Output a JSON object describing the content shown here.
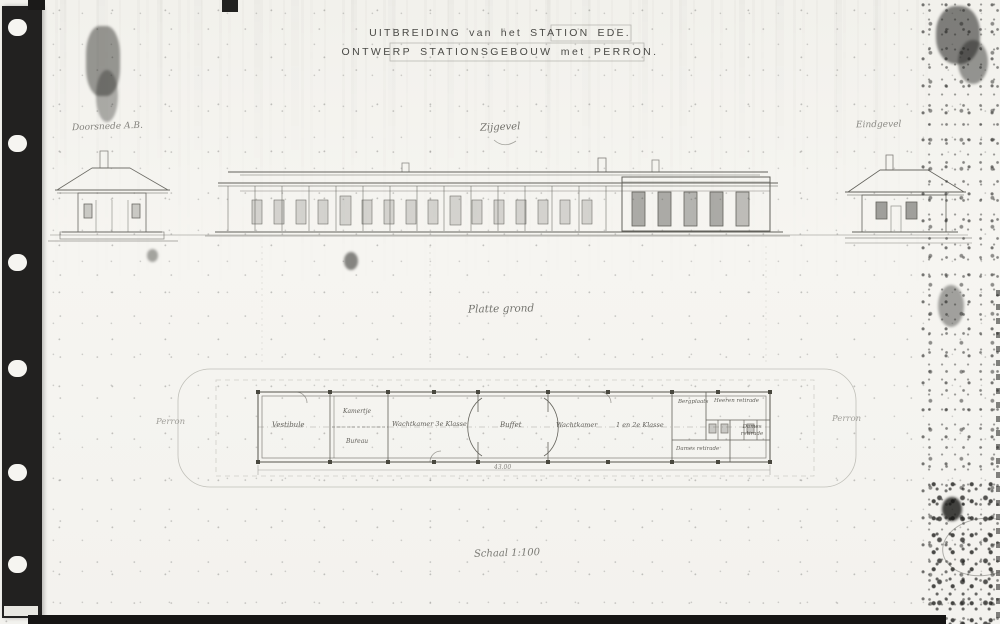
{
  "document": {
    "title_line1": "UITBREIDING van het STATION EDE.",
    "title_line2": "ONTWERP STATIONSGEBOUW met PERRON.",
    "scale_note": "Schaal 1:100"
  },
  "annotations": {
    "left_elevation": "Doorsnede A.B.",
    "side_elevation": "Zijgevel",
    "end_elevation": "Eindgevel",
    "floor_plan": "Platte grond",
    "platform_left": "Perron",
    "platform_right": "Perron",
    "dimension_length": "43.00"
  },
  "plan_rooms": {
    "vestibule": "Vestibule",
    "kamertje": "Kamertje",
    "bureau": "Bureau",
    "wachtkamer_3e_klasse": "Wachtkamer 3e Klasse",
    "buffet": "Buffet",
    "wachtkamer": "Wachtkamer",
    "klasse_1_en_2": "1 en 2e Klasse",
    "bergplaats": "Bergplaats",
    "heeren_retirade": "Heeren retirade",
    "dames_retirade_right": "Dames retirade",
    "dames_retirade_bottom": "Dames retirade"
  },
  "colors": {
    "paper": "#f4f3ef",
    "ink": "#5d5c56",
    "binding_strip": "#222120",
    "wall_ink": "#55544e"
  }
}
